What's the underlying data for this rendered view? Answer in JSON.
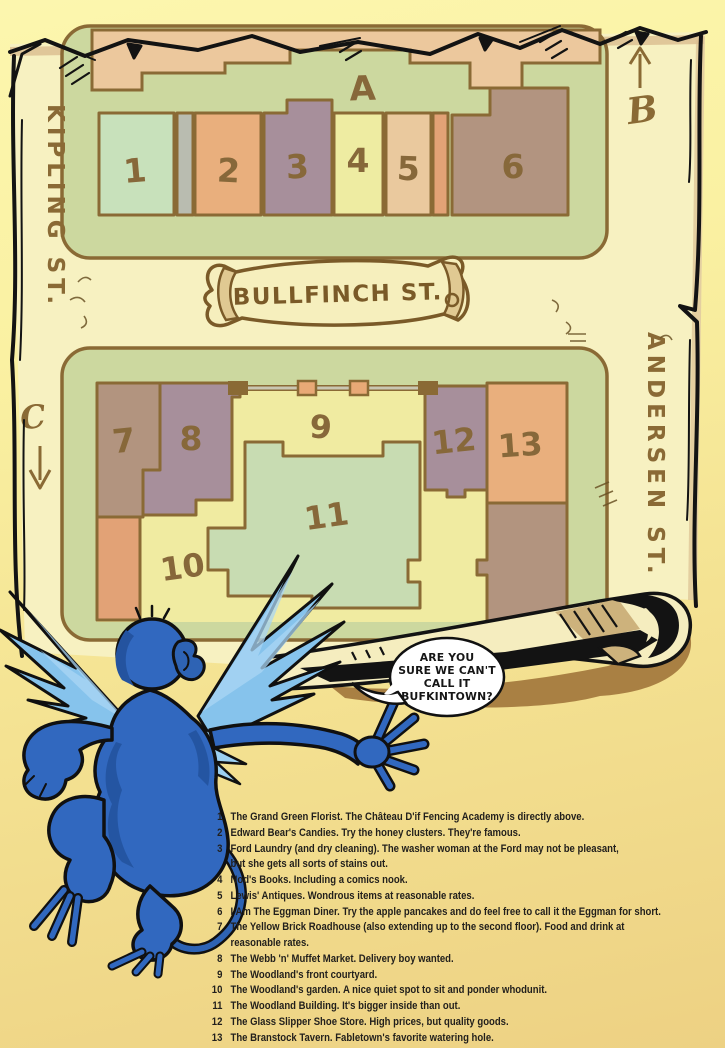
{
  "map": {
    "streets": {
      "left": "KIPLING ST.",
      "right": "ANDERSEN ST.",
      "banner": "BULLFINCH ST."
    },
    "markers": {
      "a": "A",
      "b": "B",
      "c": "C"
    },
    "buildings": [
      {
        "num": "1",
        "color": "#c8e1bb"
      },
      {
        "num": "2",
        "color": "#e9af7d"
      },
      {
        "num": "3",
        "color": "#a78f9b"
      },
      {
        "num": "4",
        "color": "#eeeca2"
      },
      {
        "num": "5",
        "color": "#eac99e"
      },
      {
        "num": "6",
        "color": "#b29480"
      },
      {
        "num": "7",
        "color": "#b2947f"
      },
      {
        "num": "8",
        "color": "#a78f9b"
      },
      {
        "num": "9",
        "color": "#f0eba1"
      },
      {
        "num": "10",
        "color": "#f0eba1"
      },
      {
        "num": "11",
        "color": "#c8dcb2"
      },
      {
        "num": "12",
        "color": "#a78f9b"
      },
      {
        "num": "13",
        "color": "#e9af7d"
      }
    ],
    "palette": {
      "parchment": "#f7f1c1",
      "block_green": "#ccd89f",
      "outline_brown": "#8a6a35",
      "label_brown": "#87683a",
      "courtyard_yellow": "#f0eba1",
      "tan_footprint": "#ecc89d",
      "gray_strip": "#b9bcb0",
      "orange_strip": "#e2a276",
      "roll_shadow": "#a98043",
      "monkey_blue": "#3168bf",
      "monkey_wing": "#86c3ec"
    }
  },
  "speech_bubble": {
    "lines": [
      "ARE YOU",
      "SURE WE CAN'T",
      "CALL IT",
      "BUFKINTOWN?"
    ]
  },
  "legend": {
    "items": [
      {
        "num": "1",
        "lines": [
          "The Grand Green Florist. The Château D'if Fencing Academy is directly above."
        ]
      },
      {
        "num": "2",
        "lines": [
          "Edward Bear's Candies. Try the honey clusters. They're famous."
        ]
      },
      {
        "num": "3",
        "lines": [
          "Ford Laundry (and dry cleaning). The washer woman at the Ford may not be pleasant,",
          "but she gets all sorts of stains out."
        ]
      },
      {
        "num": "4",
        "lines": [
          "Nod's Books. Including a comics nook."
        ]
      },
      {
        "num": "5",
        "lines": [
          "Lewis' Antiques. Wondrous items at reasonable rates."
        ]
      },
      {
        "num": "6",
        "lines": [
          "I Am The Eggman Diner. Try the apple pancakes and do feel free to call it the Eggman for short."
        ]
      },
      {
        "num": "7",
        "lines": [
          "The Yellow Brick Roadhouse (also extending up to the second floor). Food and drink at",
          "reasonable rates."
        ]
      },
      {
        "num": "8",
        "lines": [
          "The Webb 'n' Muffet Market. Delivery boy wanted."
        ]
      },
      {
        "num": "9",
        "lines": [
          "The Woodland's front courtyard."
        ]
      },
      {
        "num": "10",
        "lines": [
          "The Woodland's garden. A nice quiet spot to sit and ponder whodunit."
        ]
      },
      {
        "num": "11",
        "lines": [
          "The Woodland Building. It's bigger inside than out."
        ]
      },
      {
        "num": "12",
        "lines": [
          "The Glass Slipper Shoe Store. High prices, but quality goods."
        ]
      },
      {
        "num": "13",
        "lines": [
          "The Branstock Tavern. Fabletown's favorite watering hole."
        ]
      }
    ]
  }
}
